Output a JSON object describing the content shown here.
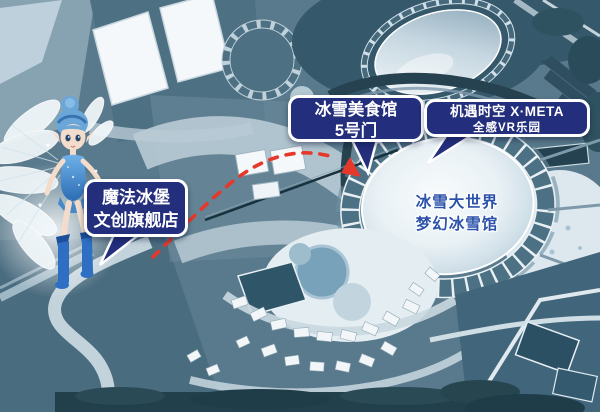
{
  "scene": {
    "type": "theme-park-navigation-map",
    "park_name": "冰雪大世界"
  },
  "callouts": {
    "magic_castle": {
      "line1": "魔法冰堡",
      "line2": "文创旗舰店"
    },
    "food_hall": {
      "line1": "冰雪美食馆",
      "line2": "5号门"
    },
    "xmeta": {
      "line1": "机遇时空 X·META",
      "line2": "全感VR乐园"
    }
  },
  "map_labels": {
    "dome_hall": {
      "line1": "冰雪大世界",
      "line2": "梦幻冰雪馆"
    }
  },
  "route": {
    "style": "red-dashed-arc-with-arrow",
    "color": "#e6382a"
  },
  "character": {
    "name": "ice-fairy-mascot"
  },
  "colors": {
    "callout_background": "#232e7d",
    "callout_border": "#ffffff",
    "callout_text": "#ffffff",
    "dome_label_text": "#2b52aa",
    "map_base": "#597a8c",
    "route_red": "#e6382a"
  }
}
